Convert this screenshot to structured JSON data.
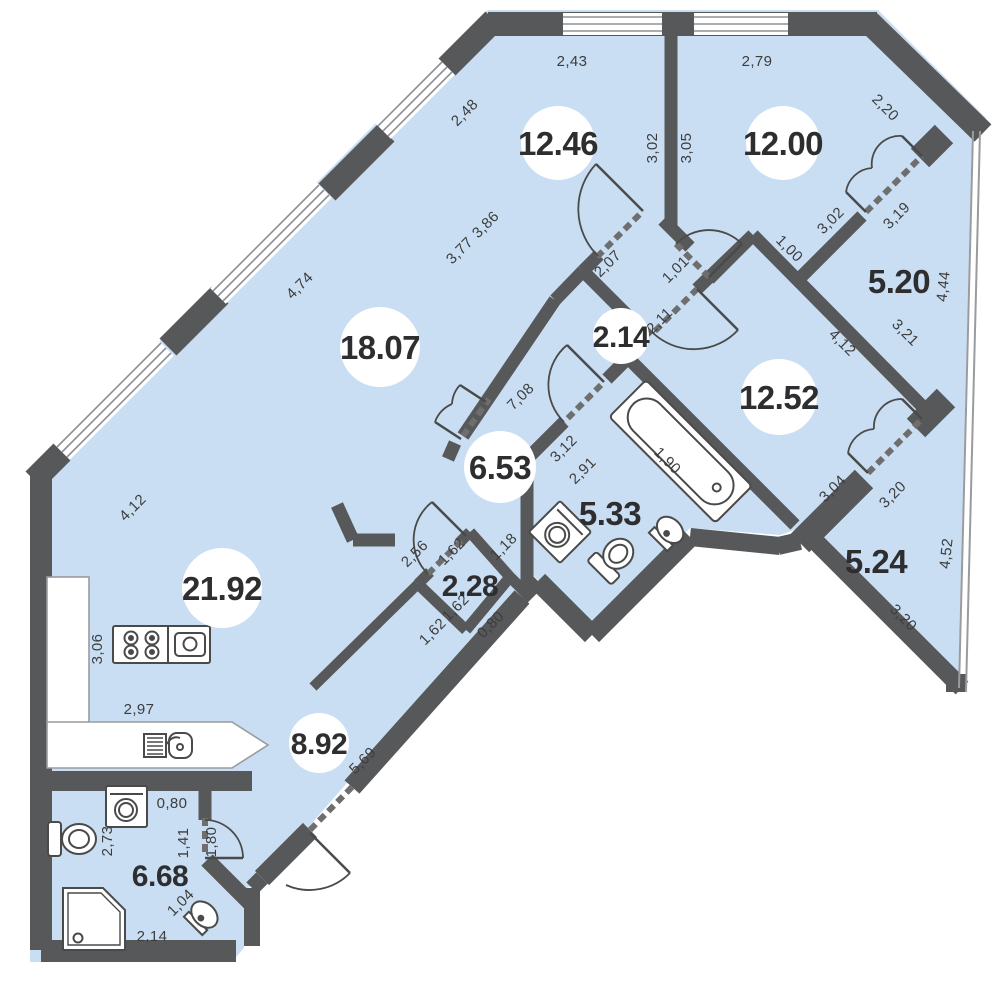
{
  "plan_type": "apartment-floor-plan",
  "colors": {
    "floor": "#c9def2",
    "wall": "#57585a",
    "door_line": "#4a4a4a",
    "window_line": "#8f9093",
    "dim_text": "#3d3d3d",
    "area_text": "#2e2e30",
    "badge": "#ffffff",
    "background": "#ffffff"
  },
  "rooms": [
    {
      "name": "room-12-46",
      "area": "12.46",
      "badge": "circle"
    },
    {
      "name": "room-12-00",
      "area": "12.00",
      "badge": "circle"
    },
    {
      "name": "balcony-5-20",
      "area": "5.20",
      "badge": "plain"
    },
    {
      "name": "hall-2-14",
      "area": "2.14",
      "badge": "circle"
    },
    {
      "name": "room-18-07",
      "area": "18.07",
      "badge": "circle"
    },
    {
      "name": "room-12-52",
      "area": "12.52",
      "badge": "circle"
    },
    {
      "name": "hall-6-53",
      "area": "6.53",
      "badge": "circle"
    },
    {
      "name": "bathroom-5-33",
      "area": "5.33",
      "badge": "plain"
    },
    {
      "name": "closet-2-28",
      "area": "2.28",
      "badge": "plain"
    },
    {
      "name": "kitchen-living-21-92",
      "area": "21.92",
      "badge": "circle"
    },
    {
      "name": "balcony-5-24",
      "area": "5.24",
      "badge": "plain"
    },
    {
      "name": "corridor-8-92",
      "area": "8.92",
      "badge": "circle"
    },
    {
      "name": "bathroom-6-68",
      "area": "6.68",
      "badge": "plain"
    }
  ],
  "dimensions": [
    {
      "value": "2,43"
    },
    {
      "value": "2,79"
    },
    {
      "value": "3,02"
    },
    {
      "value": "3,05"
    },
    {
      "value": "2,48"
    },
    {
      "value": "3,86"
    },
    {
      "value": "3,77"
    },
    {
      "value": "4,74"
    },
    {
      "value": "4,12"
    },
    {
      "value": "2,20"
    },
    {
      "value": "3,02"
    },
    {
      "value": "3,19"
    },
    {
      "value": "4,44"
    },
    {
      "value": "1,00"
    },
    {
      "value": "3,21"
    },
    {
      "value": "4,12"
    },
    {
      "value": "2,07"
    },
    {
      "value": "1,01"
    },
    {
      "value": "2,11"
    },
    {
      "value": "7,08"
    },
    {
      "value": "3,12"
    },
    {
      "value": "2,91"
    },
    {
      "value": "1,90"
    },
    {
      "value": "3,04"
    },
    {
      "value": "3,20"
    },
    {
      "value": "4,52"
    },
    {
      "value": "3,20"
    },
    {
      "value": "2,56"
    },
    {
      "value": "1,62"
    },
    {
      "value": "1,18"
    },
    {
      "value": "1,62"
    },
    {
      "value": "0,80"
    },
    {
      "value": "1,62"
    },
    {
      "value": "3,06"
    },
    {
      "value": "2,97"
    },
    {
      "value": "5,69"
    },
    {
      "value": "0,80"
    },
    {
      "value": "2,73"
    },
    {
      "value": "1,41"
    },
    {
      "value": "1,80"
    },
    {
      "value": "1,04"
    },
    {
      "value": "2,14"
    }
  ],
  "fixtures": [
    "stove-icon",
    "kitchen-sink-icon",
    "kitchen-counter",
    "bathtub-icon",
    "washing-machine-icon",
    "washing-machine-icon",
    "toilet-icon",
    "toilet-icon",
    "wash-basin-icon",
    "wash-basin-icon",
    "shower-tray-icon"
  ]
}
